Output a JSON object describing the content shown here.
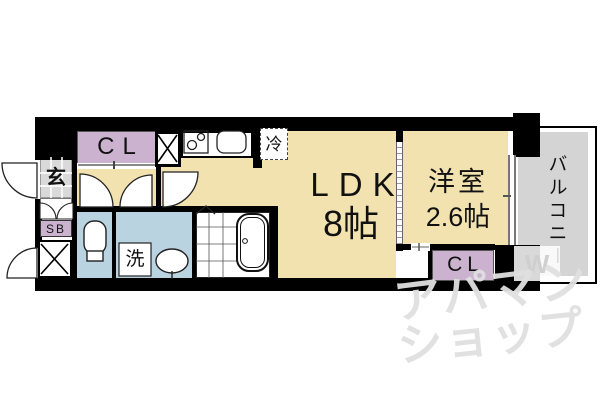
{
  "floorplan": {
    "type": "apartment-floor-plan",
    "rooms": {
      "ldk": {
        "name": "LDK",
        "size": "8帖"
      },
      "western_room": {
        "name": "洋室",
        "size": "2.6帖"
      },
      "balcony": {
        "name": "バルコニー"
      },
      "entrance": {
        "label": "玄"
      },
      "closet_top": {
        "label": "CL"
      },
      "closet_right": {
        "label": "CL"
      },
      "shoe_box": {
        "label": "SB"
      },
      "washer": {
        "label": "洗"
      },
      "refrigerator": {
        "label": "冷"
      }
    },
    "fixtures": [
      "toilet",
      "wash-basin",
      "washing-machine",
      "bathtub",
      "stove",
      "kitchen-sink",
      "refrigerator",
      "pipe-space",
      "pipe-space"
    ],
    "watermark": {
      "line1": "アパマン",
      "line2": "ショップ",
      "logo": "W"
    },
    "colors": {
      "room_floor": "#f2e2b0",
      "water_floor": "#b9d3e1",
      "closet": "#cbb3d0",
      "entrance_floor": "#d9d9d9",
      "balcony_floor": "#d4d4d4",
      "wall": "#000000",
      "watermark": "#dfdfdf"
    }
  }
}
